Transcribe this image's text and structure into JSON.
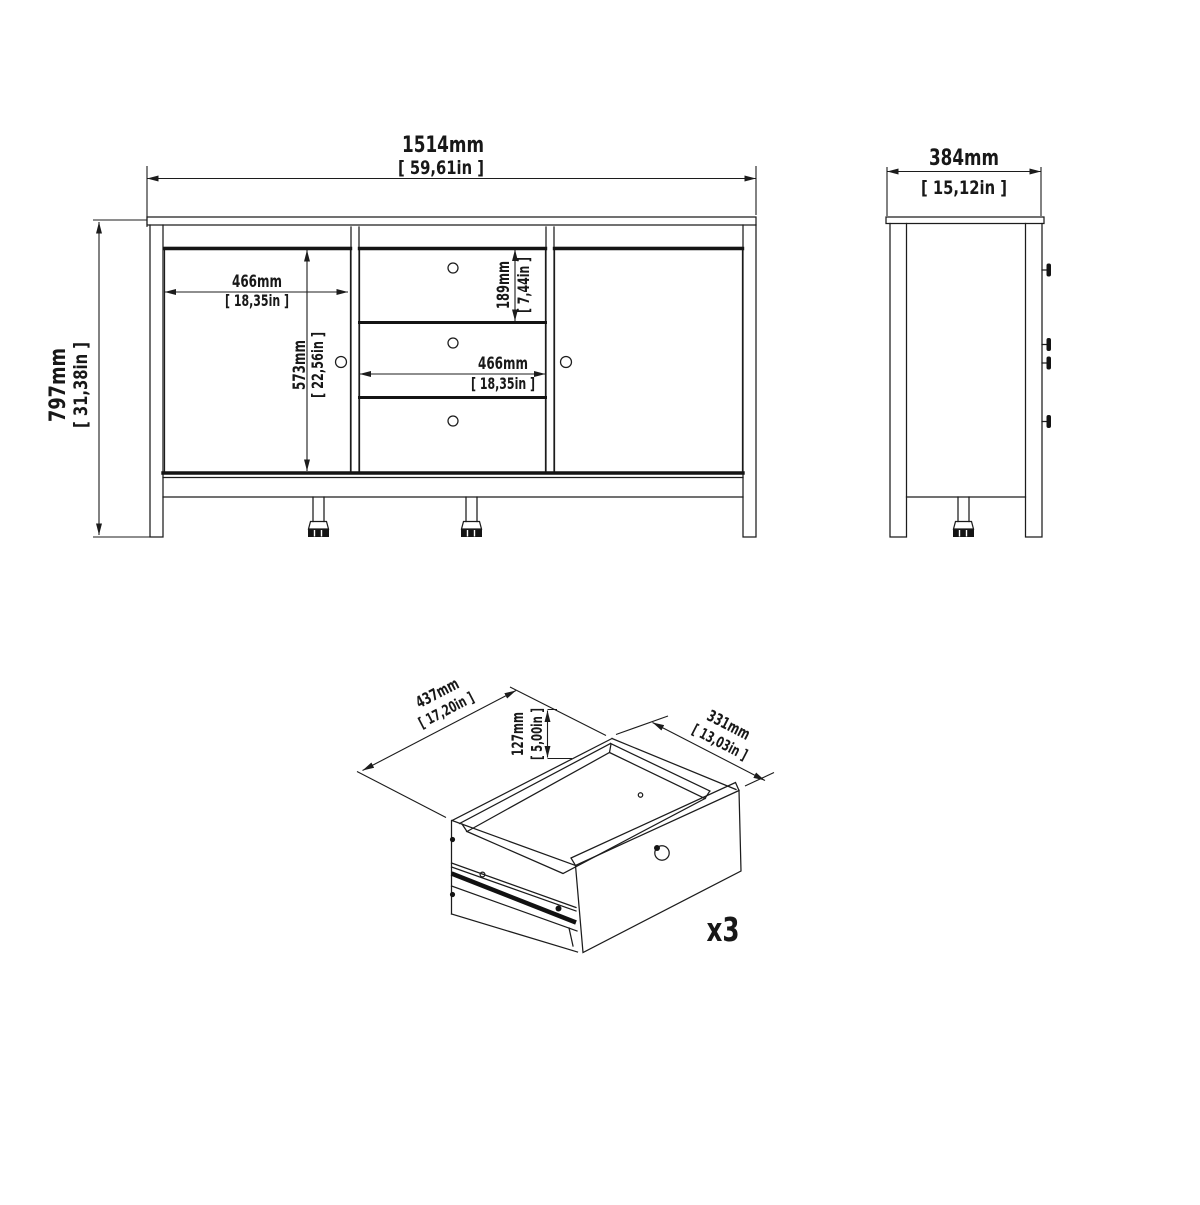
{
  "colors": {
    "line": "#1c1c1c",
    "background": "#ffffff"
  },
  "front_view": {
    "overall_width_mm": "1514mm",
    "overall_width_in": "[ 59,61in ]",
    "overall_height_mm": "797mm",
    "overall_height_in": "[ 31,38in ]",
    "door_width_mm": "466mm",
    "door_width_in": "[ 18,35in ]",
    "door_height_mm": "573mm",
    "door_height_in": "[ 22,56in ]",
    "drawer_height_mm": "189mm",
    "drawer_height_in": "[ 7,44in ]",
    "drawer_width_mm": "466mm",
    "drawer_width_in": "[ 18,35in ]"
  },
  "side_view": {
    "depth_mm": "384mm",
    "depth_in": "[ 15,12in ]"
  },
  "drawer_view": {
    "width_mm": "437mm",
    "width_in": "[ 17,20in ]",
    "height_mm": "127mm",
    "height_in": "[ 5,00in ]",
    "depth_mm": "331mm",
    "depth_in": "[ 13,03in ]",
    "quantity": "x3"
  }
}
